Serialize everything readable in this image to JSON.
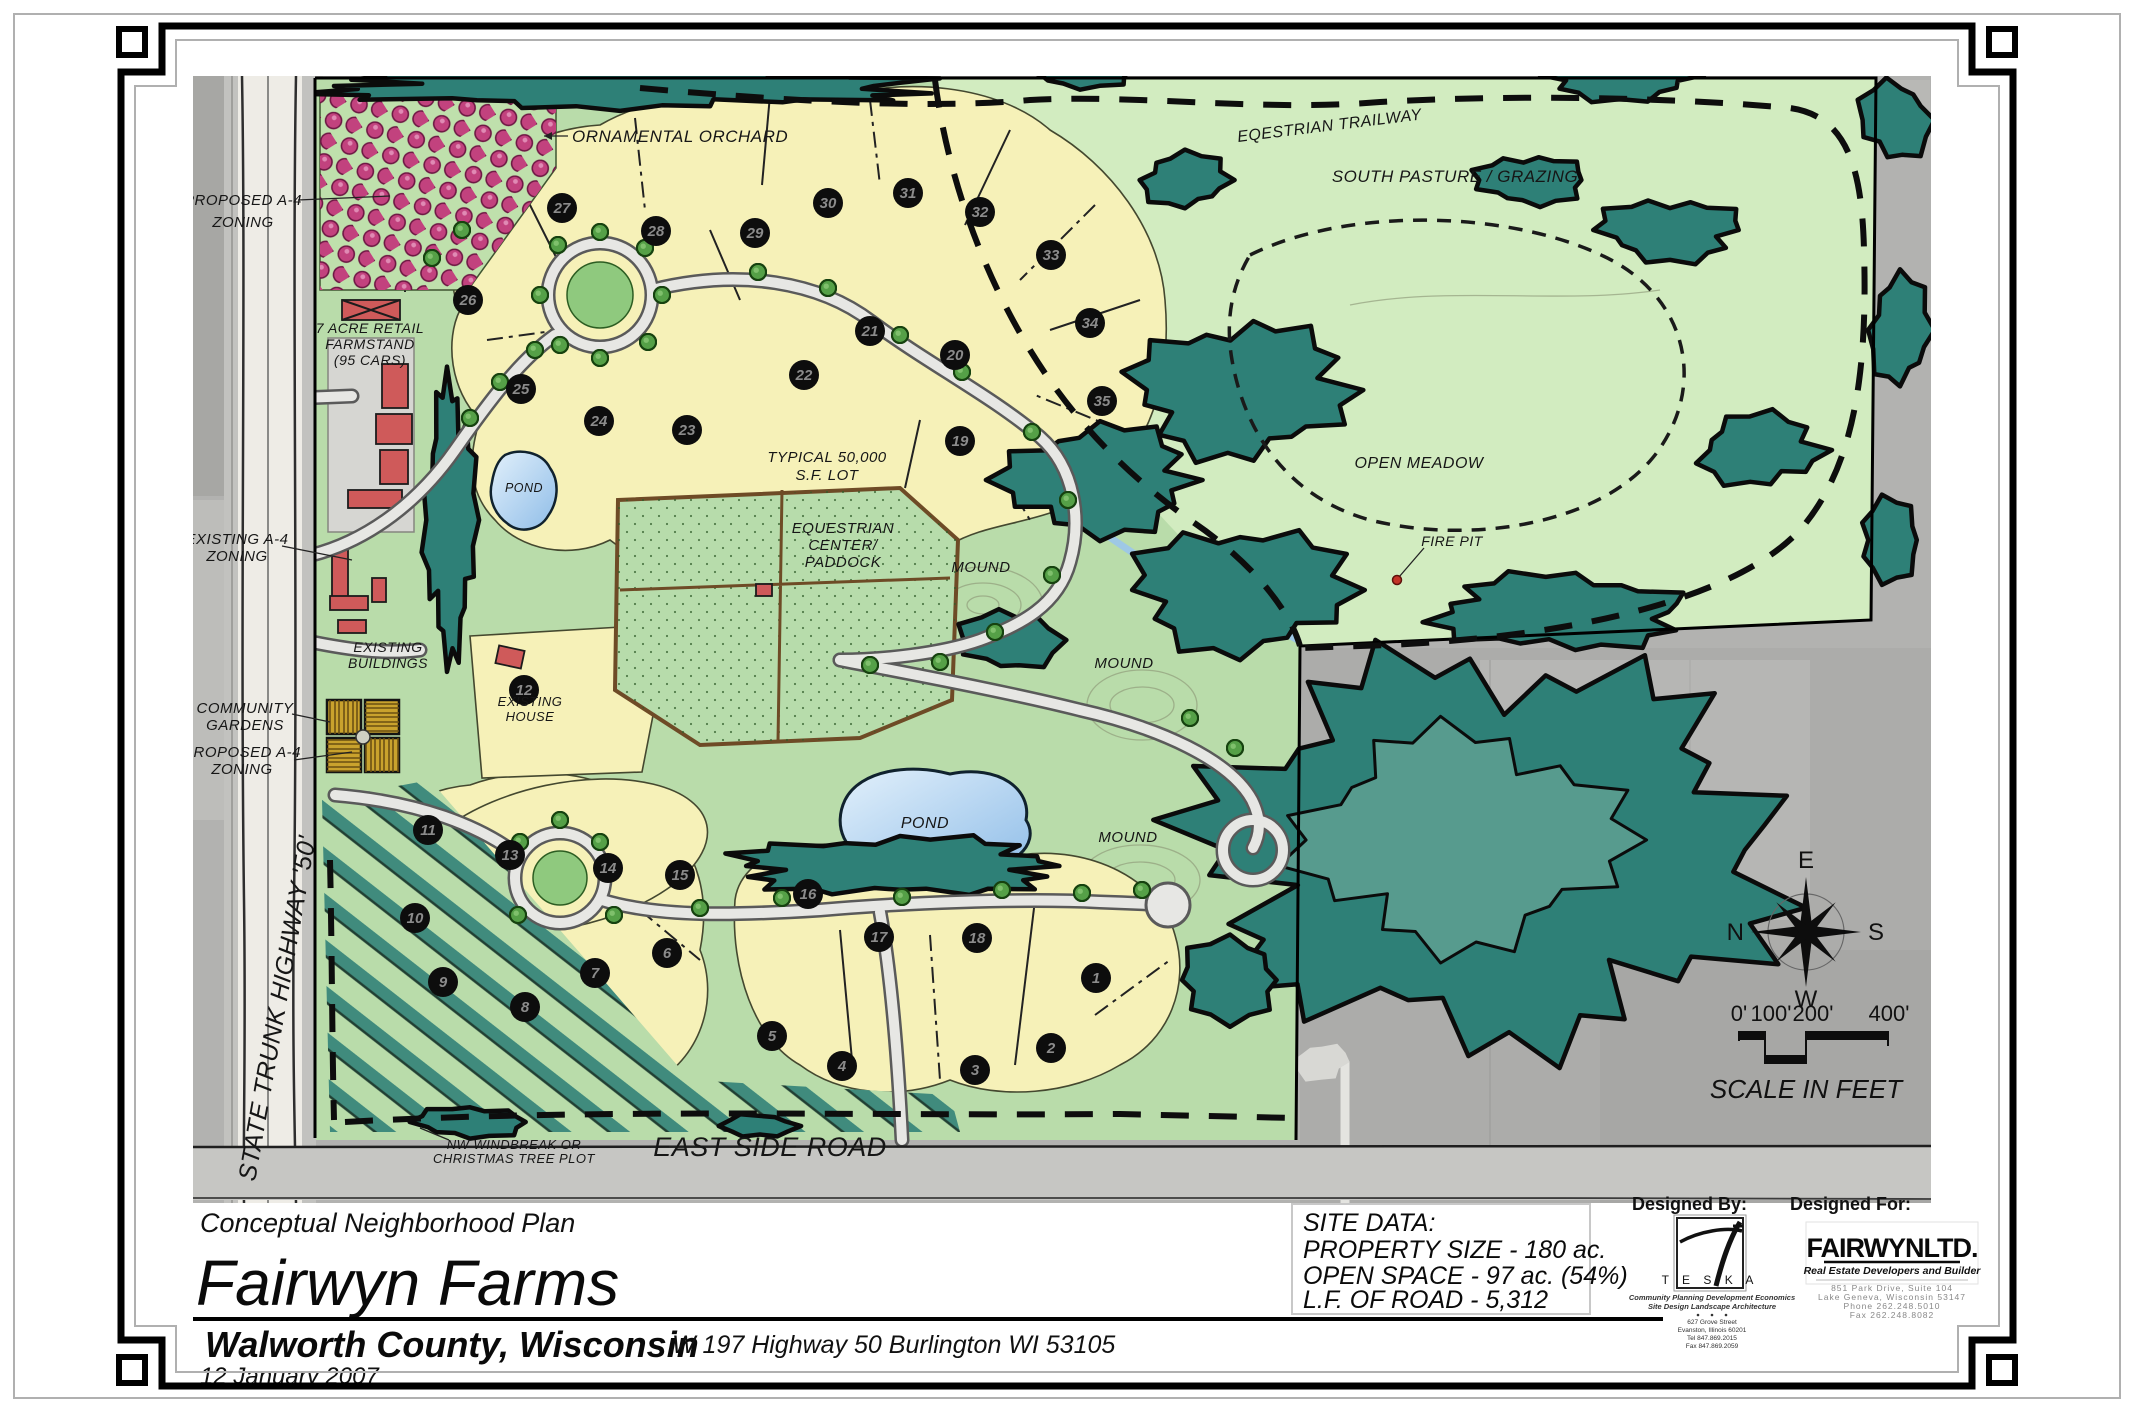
{
  "map": {
    "labels": {
      "ornamental_orchard": "ORNAMENTAL ORCHARD",
      "proposed_a4_top_line1": "PROPOSED A-4",
      "proposed_a4_top_line2": "ZONING",
      "eqestrian_trailway": "EQESTRIAN   TRAILWAY",
      "south_pasture_grazing": "SOUTH PASTURE / GRAZING",
      "retail_farmstand_line1": "7 ACRE RETAIL",
      "retail_farmstand_line2": "FARMSTAND",
      "retail_farmstand_line3": "(95 CARS)",
      "pond_west": "POND",
      "typical_lot_line1": "TYPICAL 50,000",
      "typical_lot_line2": "S.F. LOT",
      "equestrian_center_line1": "EQUESTRIAN",
      "equestrian_center_line2": "CENTER/",
      "equestrian_center_line3": "PADDOCK",
      "mound_north": "MOUND",
      "mound_east": "MOUND",
      "mound_south": "MOUND",
      "open_meadow": "OPEN MEADOW",
      "fire_pit": "FIRE PIT",
      "existing_a4_line1": "EXISTING A-4",
      "existing_a4_line2": "ZONING",
      "existing_buildings_line1": "EXISTING",
      "existing_buildings_line2": "BUILDINGS",
      "community_gardens_line1": "COMMUNITY",
      "community_gardens_line2": "GARDENS",
      "proposed_a4_south_line1": "PROPOSED A-4",
      "proposed_a4_south_line2": "ZONING",
      "existing_house_line1": "EXISTING",
      "existing_house_line2": "HOUSE",
      "pond_center": "POND",
      "state_trunk_highway": "STATE  TRUNK  HIGHWAY  '50'",
      "nw_windbreak_line1": "NW WINDBREAK OR",
      "nw_windbreak_line2": "CHRISTMAS TREE PLOT",
      "east_side_road": "EAST   SIDE   ROAD"
    },
    "lot_numbers": [
      "1",
      "2",
      "3",
      "4",
      "5",
      "6",
      "7",
      "8",
      "9",
      "10",
      "11",
      "12",
      "13",
      "14",
      "15",
      "16",
      "17",
      "18",
      "19",
      "20",
      "21",
      "22",
      "23",
      "24",
      "25",
      "26",
      "27",
      "28",
      "29",
      "30",
      "31",
      "32",
      "33",
      "34",
      "35"
    ],
    "compass": {
      "east": "E",
      "north": "N",
      "south": "S",
      "west": "W"
    },
    "scale_bar": {
      "tick_0": "0'",
      "tick_100": "100'",
      "tick_200": "200'",
      "tick_400": "400'",
      "caption": "SCALE IN FEET"
    }
  },
  "title_block": {
    "plan_type": "Conceptual Neighborhood Plan",
    "project_name": "Fairwyn Farms",
    "location": "Walworth County, Wisconsin",
    "date": "12 January 2007",
    "address": "W 197 Highway 50  Burlington  WI   53105"
  },
  "site_data": {
    "heading": "SITE DATA:",
    "property_size": "PROPERTY SIZE - 180 ac.",
    "open_space": "OPEN SPACE - 97 ac. (54%)",
    "road_length": "L.F. OF ROAD - 5,312"
  },
  "designed_by": {
    "heading": "Designed By:",
    "logo_letters": "T E S K A",
    "services_line1": "Community Planning   Development Economics",
    "services_line2": "Site Design   Landscape Architecture",
    "address_line1": "627 Grove Street",
    "address_line2": "Evanston, Illinois  60201",
    "phone": "Tel 847.869.2015",
    "fax": "Fax 847.869.2059"
  },
  "designed_for": {
    "heading": "Designed For:",
    "company": "FAIRWYNLTD.",
    "tagline": "Real Estate Developers and Builder",
    "address_line1": "851 Park Drive, Suite 104",
    "address_line2": "Lake Geneva, Wisconsin  53147",
    "phone": "Phone  262.248.5010",
    "fax": "Fax  262.248.8082"
  },
  "colors": {
    "field_green": "#b9dcaa",
    "pasture_green": "#d2ecc0",
    "lot_yellow": "#f6f1b8",
    "forest_teal": "#2e8077",
    "orchard_magenta": "#c2427e",
    "pond_blue": "#a9cdee",
    "building_red": "#cf5a5a",
    "garden_gold": "#c9a22d",
    "aerial_gray": "#b2b2b0"
  }
}
